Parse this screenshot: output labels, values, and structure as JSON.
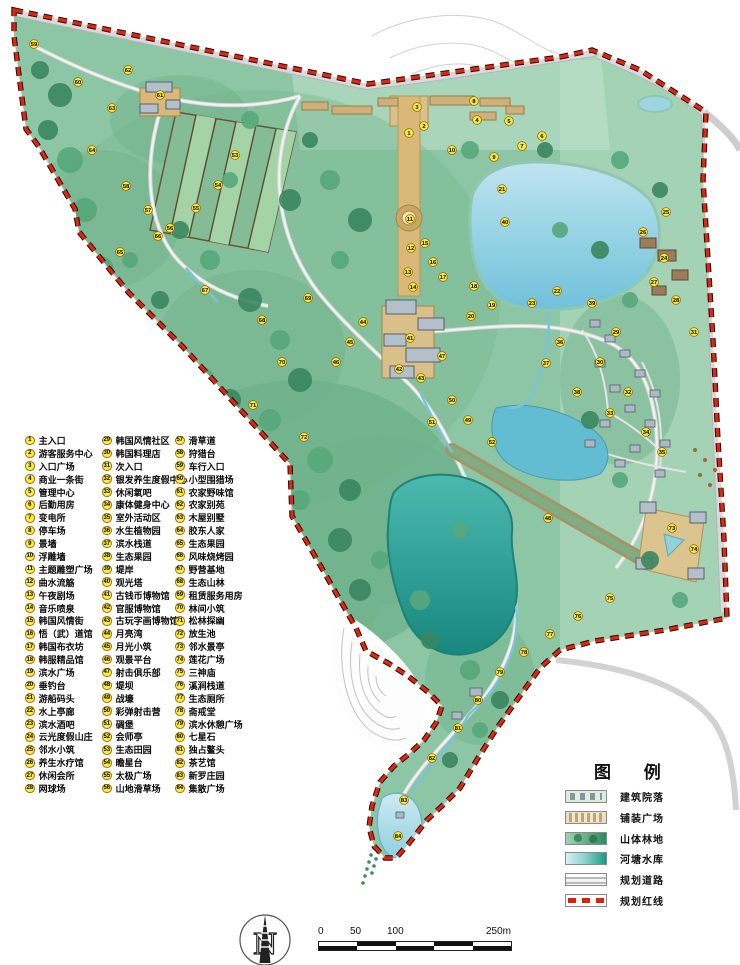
{
  "list": {
    "items": [
      {
        "n": 1,
        "label": "主入口"
      },
      {
        "n": 2,
        "label": "游客服务中心"
      },
      {
        "n": 3,
        "label": "入口广场"
      },
      {
        "n": 4,
        "label": "商业一条街"
      },
      {
        "n": 5,
        "label": "管理中心"
      },
      {
        "n": 6,
        "label": "后勤用房"
      },
      {
        "n": 7,
        "label": "变电所"
      },
      {
        "n": 8,
        "label": "停车场"
      },
      {
        "n": 9,
        "label": "景墙"
      },
      {
        "n": 10,
        "label": "浮雕墙"
      },
      {
        "n": 11,
        "label": "主题雕塑广场"
      },
      {
        "n": 12,
        "label": "曲水流觞"
      },
      {
        "n": 13,
        "label": "午夜剧场"
      },
      {
        "n": 14,
        "label": "音乐喷泉"
      },
      {
        "n": 15,
        "label": "韩国风情街"
      },
      {
        "n": 16,
        "label": "悟（武）道馆"
      },
      {
        "n": 17,
        "label": "韩国布衣坊"
      },
      {
        "n": 18,
        "label": "韩服精品馆"
      },
      {
        "n": 19,
        "label": "滨水广场"
      },
      {
        "n": 20,
        "label": "垂钓台"
      },
      {
        "n": 21,
        "label": "游船码头"
      },
      {
        "n": 22,
        "label": "水上亭廊"
      },
      {
        "n": 23,
        "label": "滨水酒吧"
      },
      {
        "n": 24,
        "label": "云光度假山庄"
      },
      {
        "n": 25,
        "label": "邻水小筑"
      },
      {
        "n": 26,
        "label": "养生水疗馆"
      },
      {
        "n": 27,
        "label": "休闲会所"
      },
      {
        "n": 28,
        "label": "网球场"
      },
      {
        "n": 29,
        "label": "韩国风情社区"
      },
      {
        "n": 30,
        "label": "韩国料理店"
      },
      {
        "n": 31,
        "label": "次入口"
      },
      {
        "n": 32,
        "label": "银发养生度假中心"
      },
      {
        "n": 33,
        "label": "休闲氧吧"
      },
      {
        "n": 34,
        "label": "康体健身中心"
      },
      {
        "n": 35,
        "label": "室外活动区"
      },
      {
        "n": 36,
        "label": "水生植物园"
      },
      {
        "n": 37,
        "label": "滨水栈道"
      },
      {
        "n": 38,
        "label": "生态果园"
      },
      {
        "n": 39,
        "label": "堤岸"
      },
      {
        "n": 40,
        "label": "观光塔"
      },
      {
        "n": 41,
        "label": "古钱币博物馆"
      },
      {
        "n": 42,
        "label": "官服博物馆"
      },
      {
        "n": 43,
        "label": "古玩字画博物馆"
      },
      {
        "n": 44,
        "label": "月亮湾"
      },
      {
        "n": 45,
        "label": "月光小筑"
      },
      {
        "n": 46,
        "label": "观景平台"
      },
      {
        "n": 47,
        "label": "射击俱乐部"
      },
      {
        "n": 48,
        "label": "堤坝"
      },
      {
        "n": 49,
        "label": "战壕"
      },
      {
        "n": 50,
        "label": "彩弹射击营"
      },
      {
        "n": 51,
        "label": "碉堡"
      },
      {
        "n": 52,
        "label": "会师亭"
      },
      {
        "n": 53,
        "label": "生态田园"
      },
      {
        "n": 54,
        "label": "瞻星台"
      },
      {
        "n": 55,
        "label": "太极广场"
      },
      {
        "n": 56,
        "label": "山地滑草场"
      },
      {
        "n": 57,
        "label": "滑草道"
      },
      {
        "n": 58,
        "label": "狩猎台"
      },
      {
        "n": 59,
        "label": "车行入口"
      },
      {
        "n": 60,
        "label": "小型围猎场"
      },
      {
        "n": 61,
        "label": "农家野味馆"
      },
      {
        "n": 62,
        "label": "农家别苑"
      },
      {
        "n": 63,
        "label": "木屋别墅"
      },
      {
        "n": 64,
        "label": "胶东人家"
      },
      {
        "n": 65,
        "label": "生态果园"
      },
      {
        "n": 66,
        "label": "风味烧烤园"
      },
      {
        "n": 67,
        "label": "野营基地"
      },
      {
        "n": 68,
        "label": "生态山林"
      },
      {
        "n": 69,
        "label": "租赁服务用房"
      },
      {
        "n": 70,
        "label": "林间小筑"
      },
      {
        "n": 71,
        "label": "松林探幽"
      },
      {
        "n": 72,
        "label": "放生池"
      },
      {
        "n": 73,
        "label": "邻水景亭"
      },
      {
        "n": 74,
        "label": "莲花广场"
      },
      {
        "n": 75,
        "label": "三神庙"
      },
      {
        "n": 76,
        "label": "溪涧栈道"
      },
      {
        "n": 77,
        "label": "生态厕所"
      },
      {
        "n": 78,
        "label": "斋戒堂"
      },
      {
        "n": 79,
        "label": "滨水休憩广场"
      },
      {
        "n": 80,
        "label": "七星石"
      },
      {
        "n": 81,
        "label": "独占鳌头"
      },
      {
        "n": 82,
        "label": "茶艺馆"
      },
      {
        "n": 83,
        "label": "新罗庄园"
      },
      {
        "n": 84,
        "label": "集散广场"
      }
    ]
  },
  "map_legend": {
    "title": "图 例",
    "entries": [
      {
        "key": "building",
        "label": "建筑院落"
      },
      {
        "key": "paving",
        "label": "铺装广场"
      },
      {
        "key": "forest",
        "label": "山体林地"
      },
      {
        "key": "water",
        "label": "河塘水库"
      },
      {
        "key": "road",
        "label": "规划道路"
      },
      {
        "key": "redline",
        "label": "规划红线"
      }
    ]
  },
  "compass": {
    "label": "N"
  },
  "scalebar": {
    "ticks": [
      {
        "label": "0",
        "x": 0
      },
      {
        "label": "50",
        "x": 32
      },
      {
        "label": "100",
        "x": 69
      },
      {
        "label": "250m",
        "x": 168
      }
    ]
  },
  "colors": {
    "redline": "#e2250f",
    "marker_fill": "#f6ec3e",
    "marker_rim": "#96660f",
    "terrain": "#8cc6a4",
    "water_light": "#aadcec",
    "water_deep": "#2fa79d",
    "road": "#cdcdcd"
  },
  "markers": [
    {
      "n": 1,
      "x": 409,
      "y": 133
    },
    {
      "n": 2,
      "x": 424,
      "y": 126
    },
    {
      "n": 3,
      "x": 417,
      "y": 107
    },
    {
      "n": 4,
      "x": 477,
      "y": 120
    },
    {
      "n": 5,
      "x": 509,
      "y": 121
    },
    {
      "n": 6,
      "x": 542,
      "y": 136
    },
    {
      "n": 7,
      "x": 522,
      "y": 146
    },
    {
      "n": 8,
      "x": 474,
      "y": 101
    },
    {
      "n": 9,
      "x": 494,
      "y": 157
    },
    {
      "n": 10,
      "x": 452,
      "y": 150
    },
    {
      "n": 11,
      "x": 410,
      "y": 219
    },
    {
      "n": 12,
      "x": 411,
      "y": 248
    },
    {
      "n": 13,
      "x": 408,
      "y": 272
    },
    {
      "n": 14,
      "x": 413,
      "y": 287
    },
    {
      "n": 15,
      "x": 425,
      "y": 243
    },
    {
      "n": 16,
      "x": 433,
      "y": 262
    },
    {
      "n": 17,
      "x": 443,
      "y": 277
    },
    {
      "n": 18,
      "x": 474,
      "y": 286
    },
    {
      "n": 19,
      "x": 492,
      "y": 305
    },
    {
      "n": 20,
      "x": 471,
      "y": 316
    },
    {
      "n": 21,
      "x": 502,
      "y": 189
    },
    {
      "n": 22,
      "x": 557,
      "y": 291
    },
    {
      "n": 23,
      "x": 532,
      "y": 303
    },
    {
      "n": 24,
      "x": 664,
      "y": 258
    },
    {
      "n": 25,
      "x": 666,
      "y": 212
    },
    {
      "n": 26,
      "x": 643,
      "y": 232
    },
    {
      "n": 27,
      "x": 654,
      "y": 282
    },
    {
      "n": 28,
      "x": 676,
      "y": 300
    },
    {
      "n": 29,
      "x": 616,
      "y": 332
    },
    {
      "n": 30,
      "x": 600,
      "y": 362
    },
    {
      "n": 31,
      "x": 694,
      "y": 332
    },
    {
      "n": 32,
      "x": 628,
      "y": 392
    },
    {
      "n": 33,
      "x": 610,
      "y": 413
    },
    {
      "n": 34,
      "x": 646,
      "y": 432
    },
    {
      "n": 35,
      "x": 662,
      "y": 452
    },
    {
      "n": 36,
      "x": 560,
      "y": 342
    },
    {
      "n": 37,
      "x": 546,
      "y": 363
    },
    {
      "n": 38,
      "x": 577,
      "y": 392
    },
    {
      "n": 39,
      "x": 592,
      "y": 303
    },
    {
      "n": 40,
      "x": 505,
      "y": 222
    },
    {
      "n": 41,
      "x": 410,
      "y": 338
    },
    {
      "n": 42,
      "x": 399,
      "y": 369
    },
    {
      "n": 43,
      "x": 421,
      "y": 378
    },
    {
      "n": 44,
      "x": 363,
      "y": 322
    },
    {
      "n": 45,
      "x": 350,
      "y": 342
    },
    {
      "n": 46,
      "x": 336,
      "y": 362
    },
    {
      "n": 47,
      "x": 442,
      "y": 356
    },
    {
      "n": 48,
      "x": 548,
      "y": 518
    },
    {
      "n": 49,
      "x": 468,
      "y": 420
    },
    {
      "n": 50,
      "x": 452,
      "y": 400
    },
    {
      "n": 51,
      "x": 432,
      "y": 422
    },
    {
      "n": 52,
      "x": 492,
      "y": 442
    },
    {
      "n": 53,
      "x": 235,
      "y": 155
    },
    {
      "n": 54,
      "x": 218,
      "y": 185
    },
    {
      "n": 55,
      "x": 196,
      "y": 208
    },
    {
      "n": 56,
      "x": 170,
      "y": 228
    },
    {
      "n": 57,
      "x": 148,
      "y": 210
    },
    {
      "n": 58,
      "x": 126,
      "y": 186
    },
    {
      "n": 59,
      "x": 34,
      "y": 44
    },
    {
      "n": 60,
      "x": 78,
      "y": 82
    },
    {
      "n": 61,
      "x": 160,
      "y": 95
    },
    {
      "n": 62,
      "x": 128,
      "y": 70
    },
    {
      "n": 63,
      "x": 112,
      "y": 108
    },
    {
      "n": 64,
      "x": 92,
      "y": 150
    },
    {
      "n": 65,
      "x": 120,
      "y": 252
    },
    {
      "n": 66,
      "x": 158,
      "y": 236
    },
    {
      "n": 67,
      "x": 205,
      "y": 290
    },
    {
      "n": 68,
      "x": 262,
      "y": 320
    },
    {
      "n": 69,
      "x": 308,
      "y": 298
    },
    {
      "n": 70,
      "x": 282,
      "y": 362
    },
    {
      "n": 71,
      "x": 253,
      "y": 405
    },
    {
      "n": 72,
      "x": 304,
      "y": 437
    },
    {
      "n": 73,
      "x": 672,
      "y": 528
    },
    {
      "n": 74,
      "x": 694,
      "y": 549
    },
    {
      "n": 75,
      "x": 610,
      "y": 598
    },
    {
      "n": 76,
      "x": 578,
      "y": 616
    },
    {
      "n": 77,
      "x": 550,
      "y": 634
    },
    {
      "n": 78,
      "x": 524,
      "y": 652
    },
    {
      "n": 79,
      "x": 500,
      "y": 672
    },
    {
      "n": 80,
      "x": 478,
      "y": 700
    },
    {
      "n": 81,
      "x": 458,
      "y": 728
    },
    {
      "n": 82,
      "x": 432,
      "y": 758
    },
    {
      "n": 83,
      "x": 404,
      "y": 800
    },
    {
      "n": 84,
      "x": 398,
      "y": 836
    }
  ]
}
